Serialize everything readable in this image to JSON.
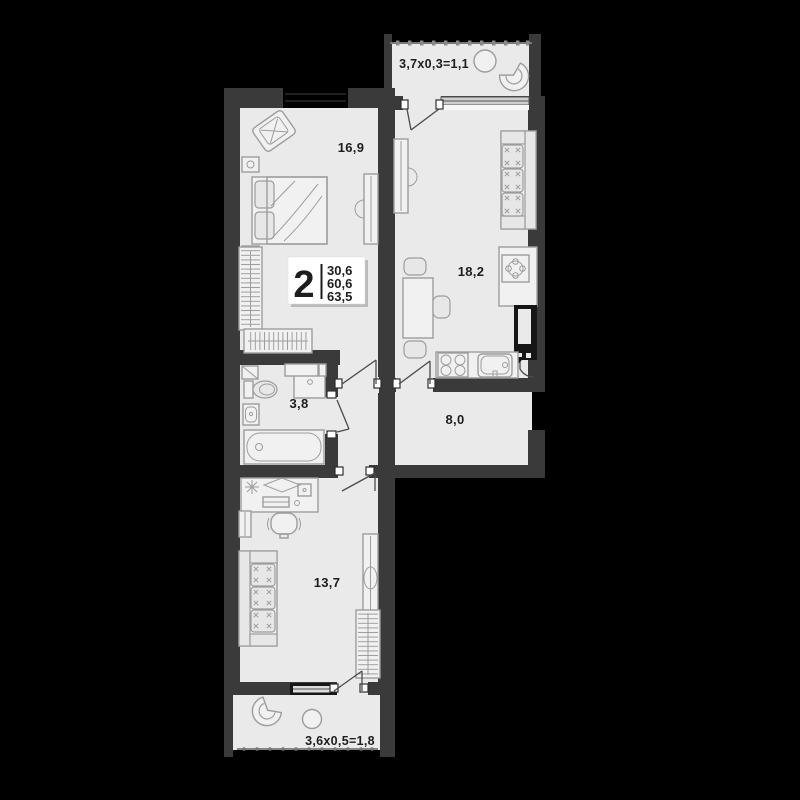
{
  "plan": {
    "type": "apartment-floor-plan",
    "labels": {
      "bedroom": "16,9",
      "kitchen_living": "18,2",
      "bathroom": "3,8",
      "hallway": "8,0",
      "room": "13,7",
      "balcony_top": "3,7х0,3=1,1",
      "balcony_bottom": "3,6х0,5=1,8"
    },
    "info_badge": {
      "rooms_count": "2",
      "area_living": "30,6",
      "area_usable": "60,6",
      "area_total": "63,5"
    },
    "colors": {
      "background": "#000000",
      "wall": "#3a3a3a",
      "floor": "#eaeaea",
      "furniture_line": "#9d9d9d",
      "black_detail": "#161616",
      "badge_bg": "#ffffff",
      "label_text": "#1d1d1d"
    }
  }
}
